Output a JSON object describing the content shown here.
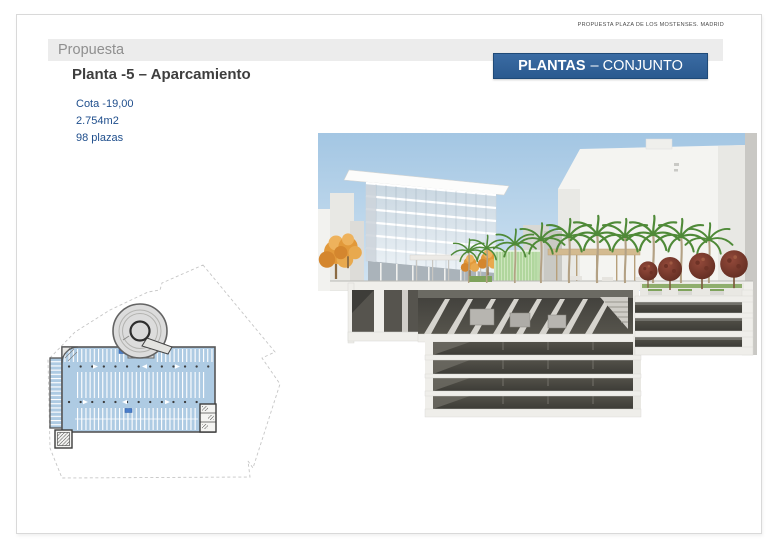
{
  "slide": {
    "note": "PROPUESTA PLAZA DE LOS MOSTENSES. MADRID",
    "section_label": "Propuesta",
    "title": "Planta -5 – Aparcamiento",
    "tag": {
      "primary": "PLANTAS",
      "secondary": "– CONJUNTO"
    },
    "stats": {
      "cota": "Cota -19,00",
      "area": "2.754m2",
      "capacity": "98 plazas"
    }
  },
  "colors": {
    "accent_blue": "#2d5e94",
    "stats_blue": "#1f4e8c",
    "plan_fill_blue": "#aecbe3",
    "section_label_gray": "#8f8f8f",
    "title_gray": "#3e3e3e",
    "sky_blue": "#a6c8e5",
    "bar_gray": "#ececec"
  }
}
